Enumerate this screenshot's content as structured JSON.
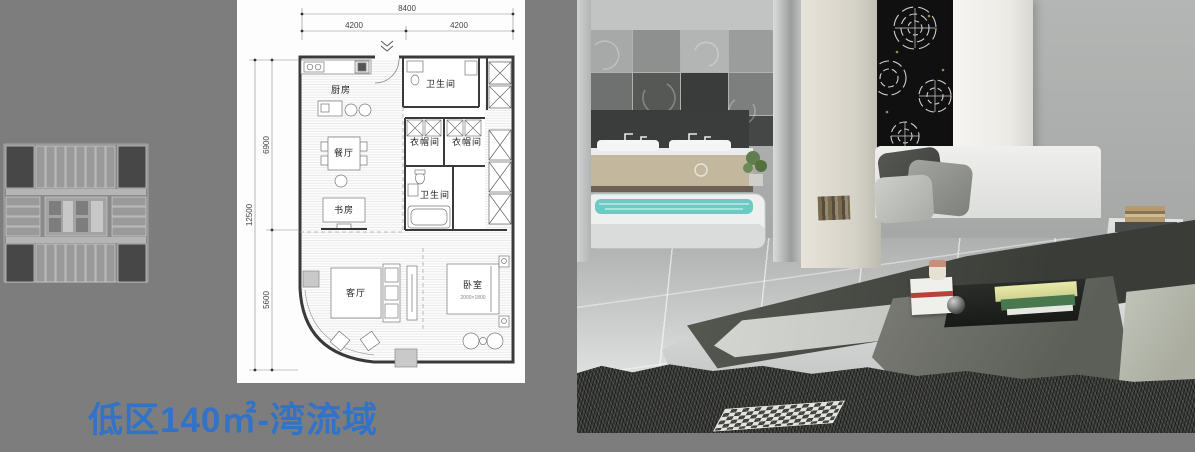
{
  "title": {
    "text": "低区140㎡-湾流域"
  },
  "colors": {
    "background": "#7d7d7d",
    "title_blue": "#3273c8",
    "plan_wall": "#3a3a3a",
    "bath_water_teal": "#6cc9c3",
    "art_panel_black": "#101010"
  },
  "floor_plan": {
    "dims": {
      "top_total": "8400",
      "top_left": "4200",
      "top_right": "4200",
      "left_total": "12500",
      "left_upper": "6900",
      "left_lower": "5600"
    },
    "rooms": {
      "kitchen": "厨房",
      "bath_top": "卫生间",
      "closet_left": "衣帽间",
      "closet_right": "衣帽间",
      "bath_mid": "卫生间",
      "dining": "餐厅",
      "study": "书房",
      "living": "客厅",
      "bedroom": "卧室"
    },
    "bed_size": "2000×1800"
  }
}
